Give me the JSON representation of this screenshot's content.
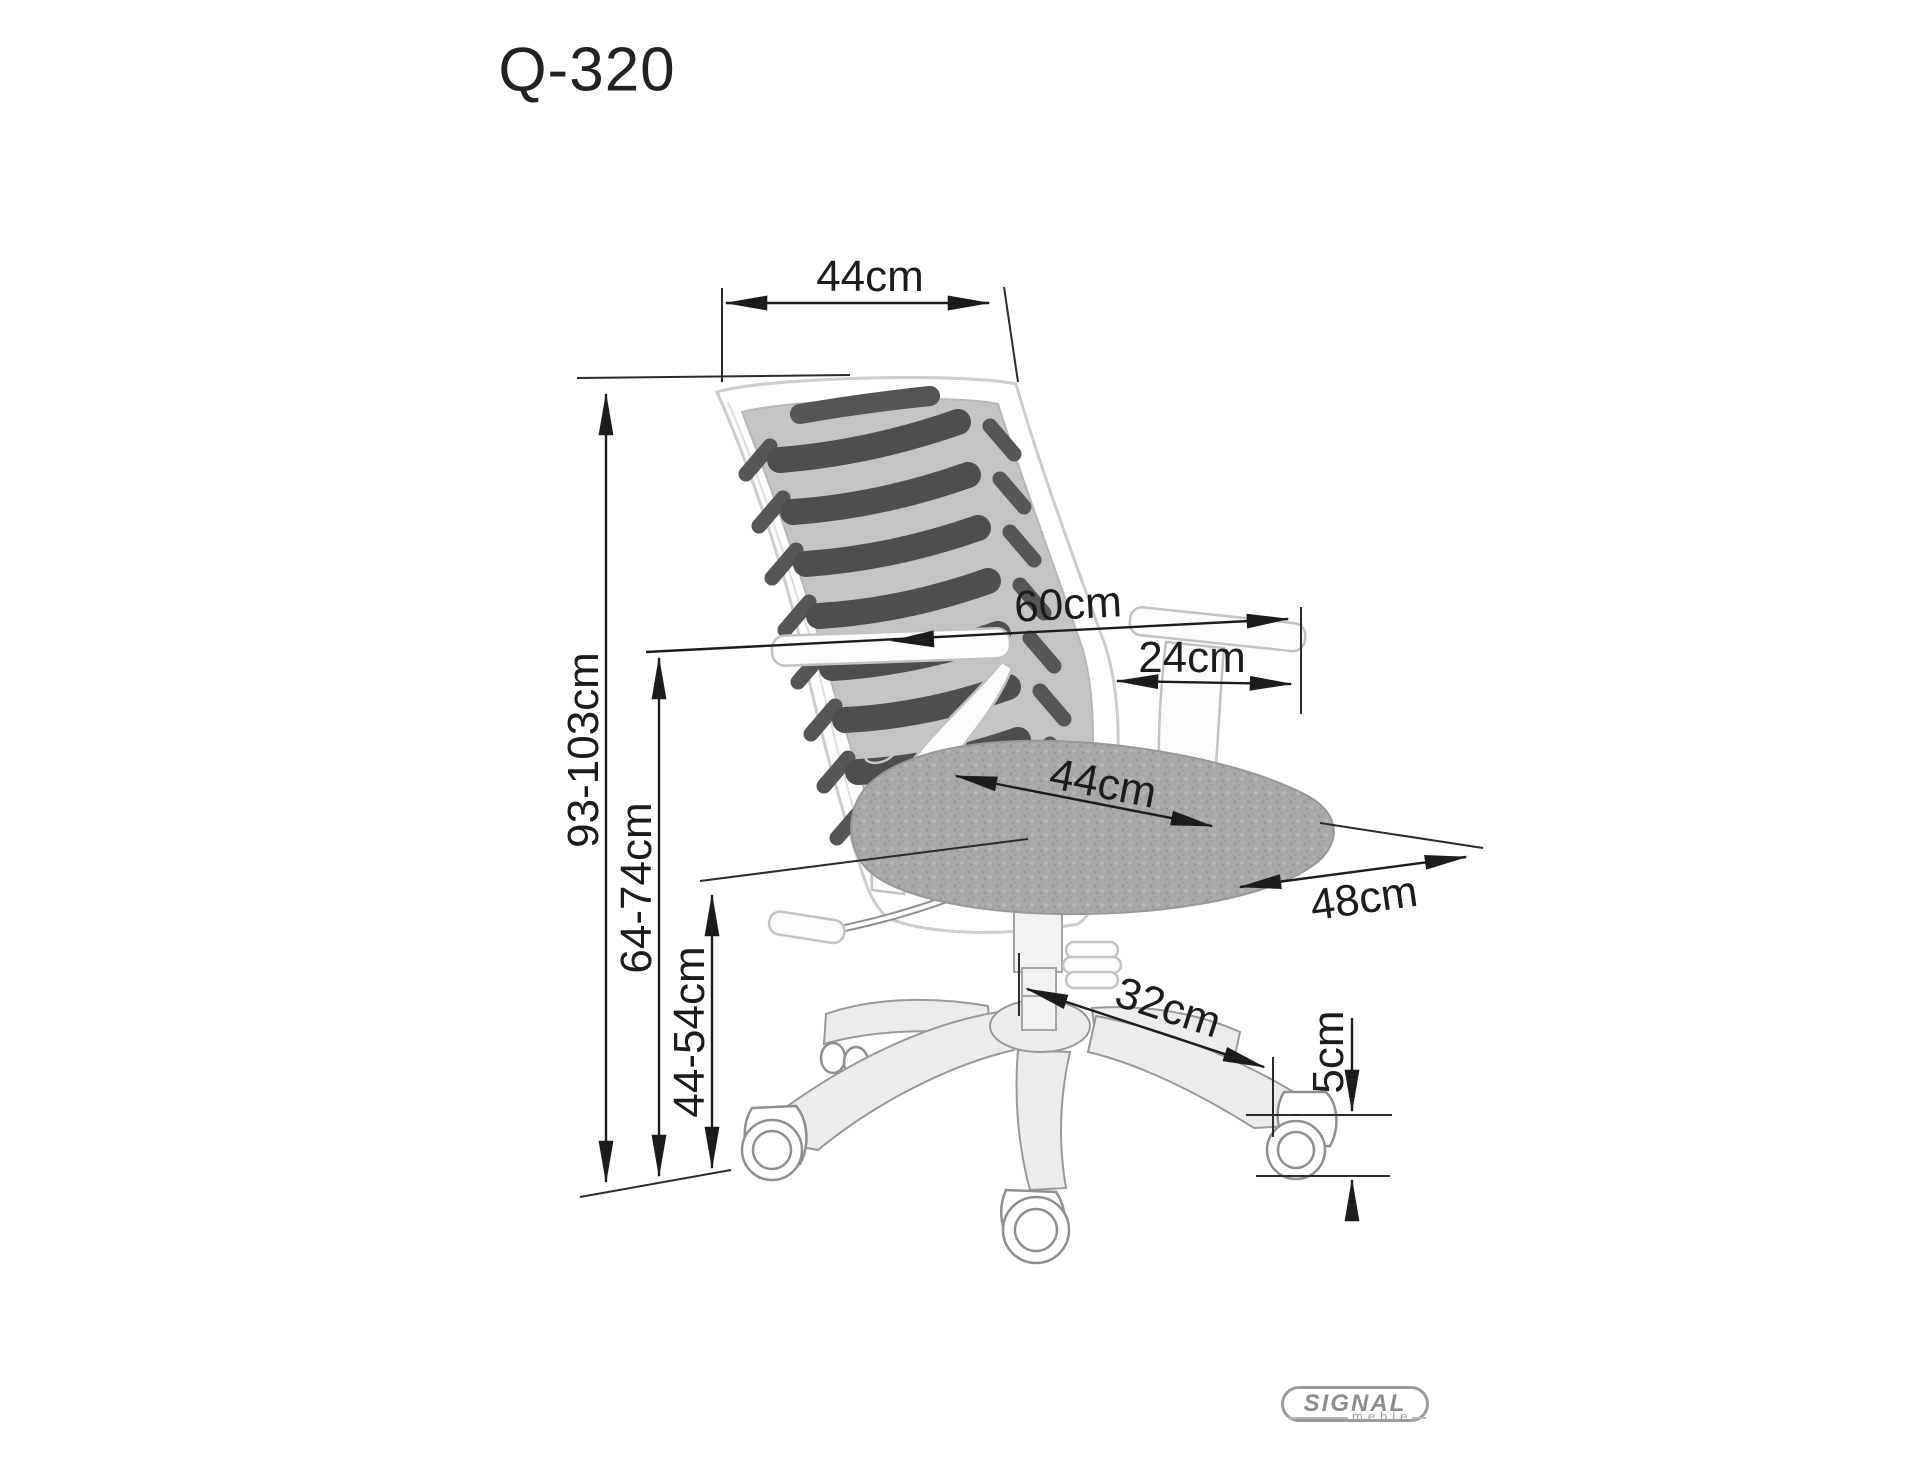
{
  "title": "Q-320",
  "dimensions": {
    "backrest_width": "44cm",
    "overall_height": "93-103cm",
    "floor_to_armrest": "64-74cm",
    "seat_height": "44-54cm",
    "overall_width": "60cm",
    "armrest_length": "24cm",
    "seat_width": "44cm",
    "seat_depth": "48cm",
    "base_leg_reach": "32cm",
    "caster_diameter": "5cm"
  },
  "logo": {
    "brand": "SIGNAL",
    "subtitle": "meble"
  },
  "colors": {
    "background": "#ffffff",
    "dimension_line": "#1c1c1c",
    "mesh_slat": "#4e4e4e",
    "mesh_background": "#c4c4c4",
    "seat_fabric": "#a8a8a8",
    "chair_outline": "#9a9a9a",
    "logo_gray": "#8d8d8d"
  }
}
